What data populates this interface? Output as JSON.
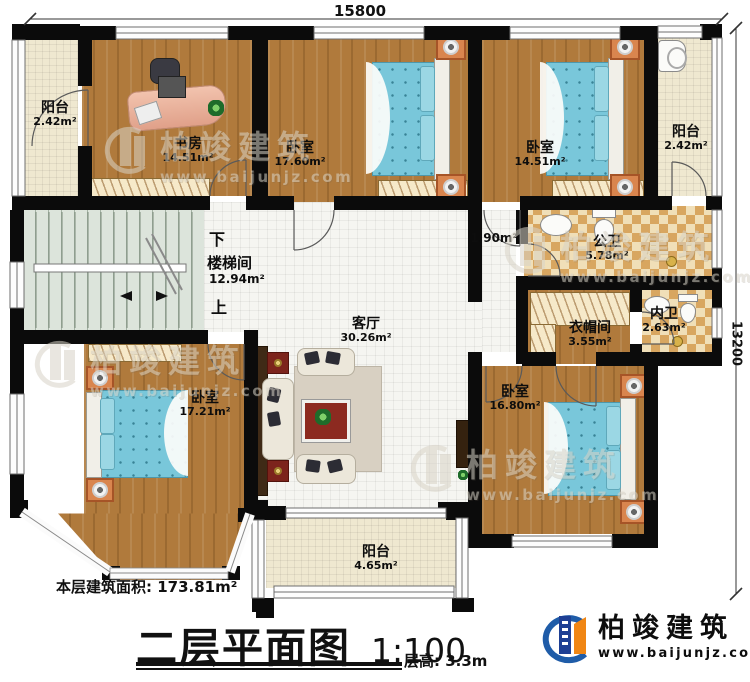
{
  "plan": {
    "dim_top": "15800",
    "dim_right": "13200",
    "stairs": {
      "down": "下",
      "up": "上"
    },
    "rooms": {
      "balcony_tl": {
        "name": "阳台",
        "area": "2.42m²"
      },
      "study": {
        "name": "书房",
        "area": "14.51m²"
      },
      "bedroom_top_mid": {
        "name": "卧室",
        "area": "17.60m²"
      },
      "bedroom_top_right": {
        "name": "卧室",
        "area": "14.51m²"
      },
      "balcony_tr": {
        "name": "阳台",
        "area": "2.42m²"
      },
      "corridor": {
        "area": "1.90m²"
      },
      "public_bath": {
        "name": "公卫",
        "area": "5.78m²"
      },
      "inner_bath": {
        "name": "内卫",
        "area": "2.63m²"
      },
      "cloakroom": {
        "name": "衣帽间",
        "area": "3.55m²"
      },
      "stairwell": {
        "name": "楼梯间",
        "area": "12.94m²"
      },
      "living": {
        "name": "客厅",
        "area": "30.26m²"
      },
      "bedroom_bottom_left": {
        "name": "卧室",
        "area": "17.21m²"
      },
      "bedroom_bottom_right": {
        "name": "卧室",
        "area": "16.80m²"
      },
      "balcony_bottom": {
        "name": "阳台",
        "area": "4.65m²"
      }
    }
  },
  "footer": {
    "floor_area_label": "本层建筑面积: 173.81m²",
    "title": "二层平面图",
    "scale": "1:100",
    "floor_height": "层高: 3.3m"
  },
  "brand": {
    "name": "柏竣建筑",
    "url": "www.baijunjz.com"
  },
  "watermark": {
    "name": "柏竣建筑",
    "url": "www.baijunjz.com"
  },
  "colors": {
    "wall": "#0b0b0b",
    "wood_floor": "#b07a3c",
    "cream_tile": "#efe8d0",
    "white_tile": "#f5f5f1",
    "checker_tan": "#d8a660",
    "stair_green": "#dce4db",
    "bed_blue": "#79c7da",
    "nightstand_orange": "#d9854e",
    "accent_red": "#7c241c",
    "logo_blue": "#1f5ca8",
    "logo_orange": "#f08614"
  }
}
